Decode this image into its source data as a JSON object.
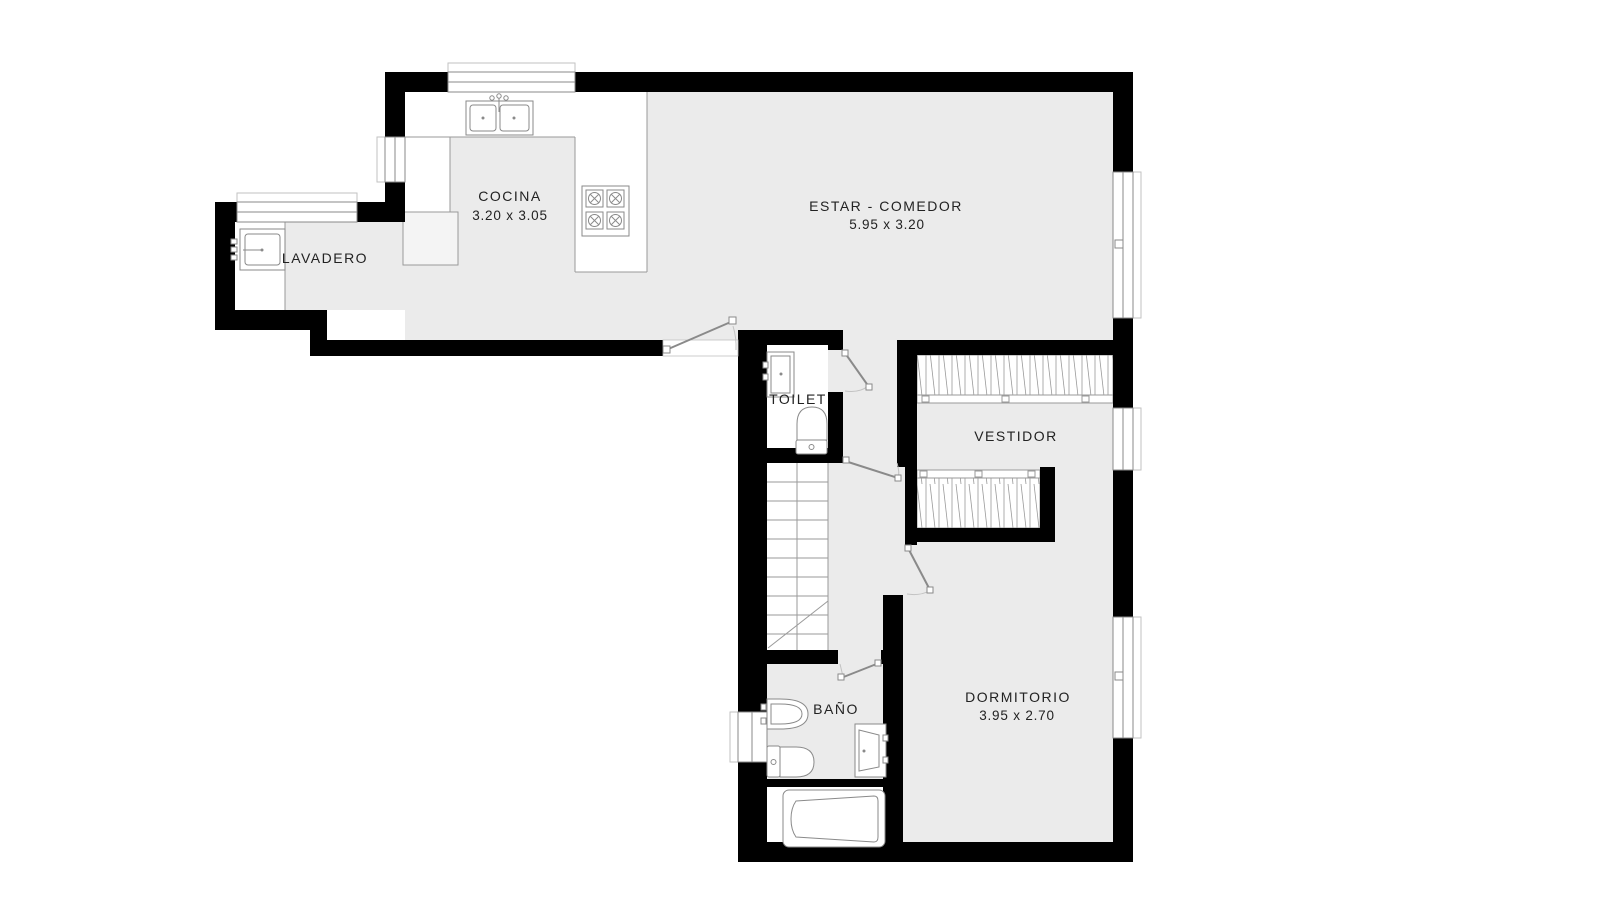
{
  "plan_title": "floor-plan",
  "colors": {
    "wall": "#000000",
    "floor": "#ebebeb",
    "fixture_line": "#8a8a8a",
    "counter_line": "#9a9a9a",
    "arc_line": "#c2c2c2",
    "text": "#222222",
    "background": "#ffffff"
  },
  "rooms": {
    "cocina": {
      "label": "COCINA",
      "dims": "3.20 x 3.05"
    },
    "estar_comedor": {
      "label": "ESTAR - COMEDOR",
      "dims": "5.95 x 3.20"
    },
    "lavadero": {
      "label": "LAVADERO"
    },
    "toilet": {
      "label": "TOILET"
    },
    "vestidor": {
      "label": "VESTIDOR"
    },
    "dormitorio": {
      "label": "DORMITORIO",
      "dims": "3.95 x 2.70"
    },
    "bano": {
      "label": "BAÑO"
    }
  }
}
